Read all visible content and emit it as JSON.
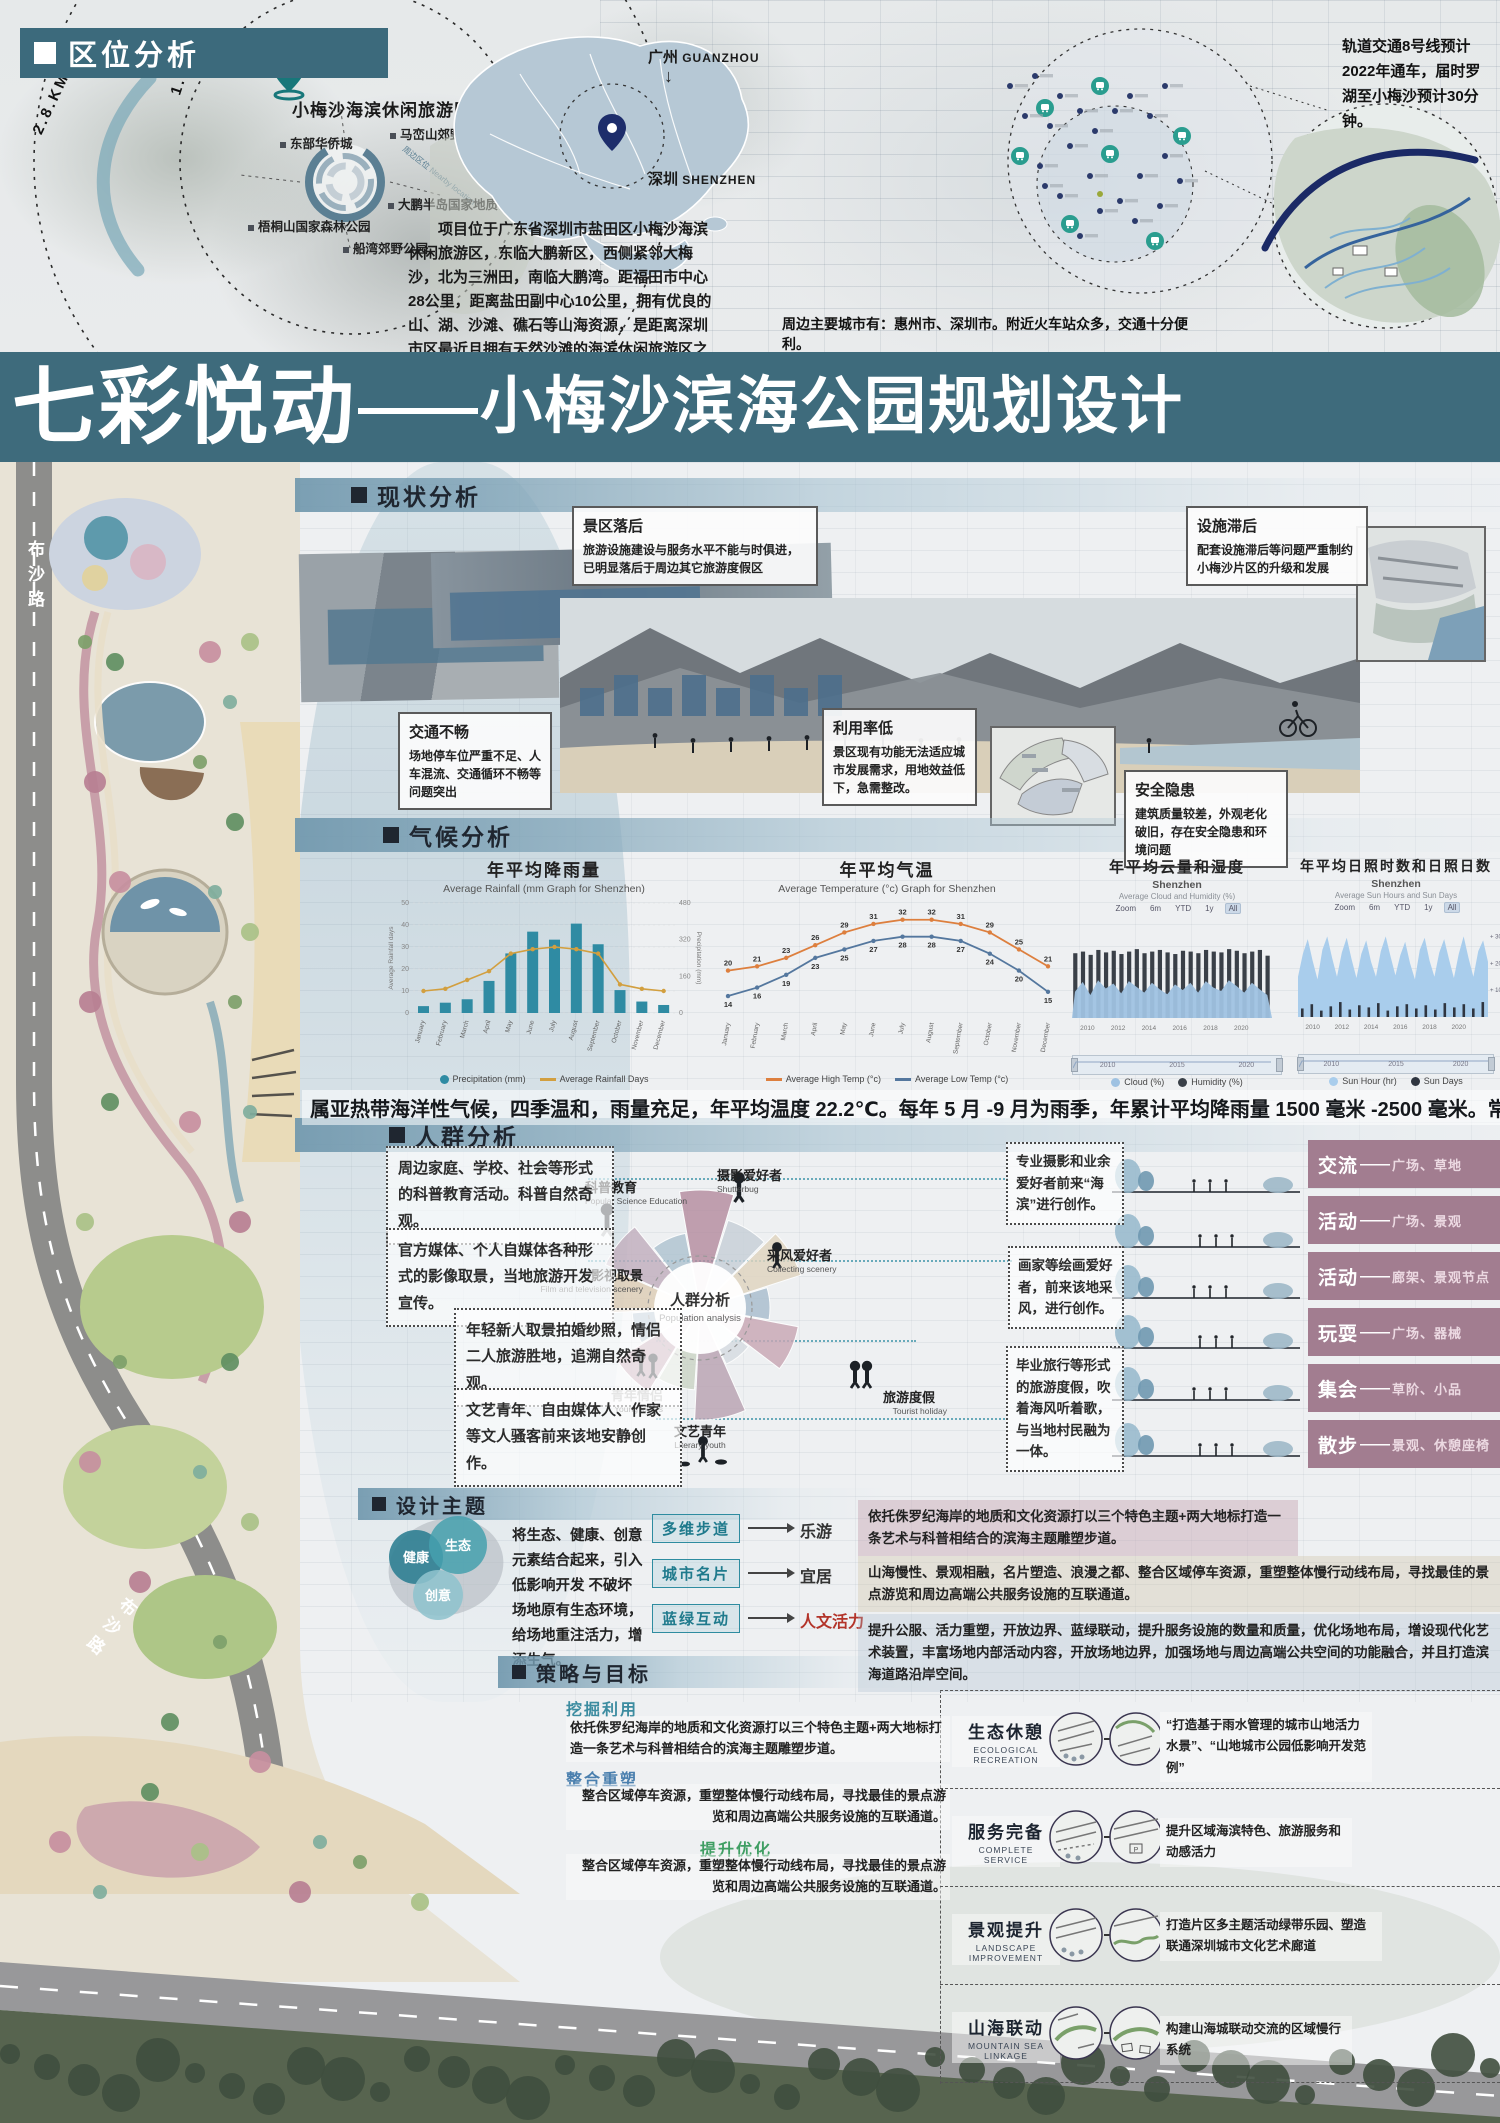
{
  "location_analysis": {
    "header": "区位分析",
    "radius_labels": [
      "2.8.KM",
      "1.0KM"
    ],
    "site_pin_label": "小梅沙海滨休闲旅游区",
    "nearby_ring_label": "周边区位 Nearby location",
    "poi_labels": [
      "东部华侨城",
      "马峦山郊野公园",
      "梧桐山国家森林公园",
      "船湾郊野公园",
      "大鹏半岛国家地质公园"
    ],
    "city_guangzhou": {
      "zh": "广州",
      "en": "GUANZHOU"
    },
    "city_shenzhen": {
      "zh": "深圳",
      "en": "SHENZHEN"
    },
    "arrow_down": "↓",
    "intro_paragraph": "项目位于广东省深圳市盐田区小梅沙海滨休闲旅游区，东临大鹏新区，西侧紧邻大梅沙，北为三洲田，南临大鹏湾。距福田市中心28公里，距离盐田副中心10公里，拥有优良的山、湖、沙滩、礁石等山海资源，是距离深圳市区最近且拥有天然沙滩的海滨休闲旅游区之一。",
    "transit_note": "轨道交通8号线预计2022年通车，届时罗湖至小梅沙预计30分钟。",
    "cities_note": "周边主要城市有：惠州市、深圳市。附近火车站众多，交通十分便利。"
  },
  "title_banner": {
    "lead": "七彩悦动",
    "dash": "——",
    "rest": "小梅沙滨海公园规划设计"
  },
  "masterplan": {
    "road_label": "布沙路"
  },
  "status_analysis": {
    "header": "现状分析",
    "callouts": [
      {
        "title": "景区落后",
        "body": "旅游设施建设与服务水平不能与时俱进，已明显落后于周边其它旅游度假区"
      },
      {
        "title": "设施滞后",
        "body": "配套设施滞后等问题严重制约小梅沙片区的升级和发展"
      },
      {
        "title": "交通不畅",
        "body": "场地停车位严重不足、人车混流、交通循环不畅等问题突出"
      },
      {
        "title": "利用率低",
        "body": "景区现有功能无法适应城市发展需求，用地效益低下，急需整改。"
      },
      {
        "title": "安全隐患",
        "body": "建筑质量较差，外观老化破旧，存在安全隐患和环境问题"
      }
    ]
  },
  "climate_analysis": {
    "header": "气候分析",
    "summary": "属亚热带海洋性气候，四季温和，雨量充足，年平均温度 22.2℃。每年 5 月 -9 月为雨季，年累计平均降雨量 1500 毫米 -2500 毫米。常年主导风向为东北偏北。"
  },
  "chart_data": [
    {
      "type": "bar",
      "title": "年平均降雨量",
      "subtitle": "Average Rainfall (mm Graph for Shenzhen)",
      "categories": [
        "January",
        "February",
        "March",
        "April",
        "May",
        "June",
        "July",
        "August",
        "September",
        "October",
        "November",
        "December"
      ],
      "series": [
        {
          "name": "Precipitation (mm)",
          "type": "bar",
          "color": "#2f8ba3",
          "values": [
            30,
            45,
            60,
            140,
            260,
            355,
            320,
            390,
            300,
            100,
            50,
            35
          ]
        },
        {
          "name": "Average Rainfall Days",
          "type": "line",
          "color": "#d29f3f",
          "values": [
            10,
            11,
            15,
            19,
            27,
            29,
            30,
            29,
            27,
            13,
            11,
            10
          ]
        }
      ],
      "y_left": {
        "label": "Average Rainfall days",
        "min": 0,
        "max": 50,
        "ticks": [
          0,
          10,
          20,
          30,
          40,
          50
        ]
      },
      "y_right": {
        "label": "Precipitation (mm)",
        "min": 0,
        "max": 480,
        "ticks": [
          0,
          160,
          320,
          480
        ]
      }
    },
    {
      "type": "line",
      "title": "年平均气温",
      "subtitle": "Average Temperature (°c) Graph for Shenzhen",
      "categories": [
        "January",
        "February",
        "March",
        "April",
        "May",
        "June",
        "July",
        "August",
        "September",
        "October",
        "November",
        "December"
      ],
      "series": [
        {
          "name": "Average High Temp (°c)",
          "type": "line",
          "color": "#dd7f3e",
          "values": [
            20,
            21,
            23,
            26,
            29,
            31,
            32,
            32,
            31,
            29,
            25,
            21
          ]
        },
        {
          "name": "Average Low Temp (°c)",
          "type": "line",
          "color": "#54779e",
          "values": [
            14,
            16,
            19,
            23,
            25,
            27,
            28,
            28,
            27,
            24,
            20,
            15
          ]
        }
      ],
      "ylim": [
        10,
        35
      ]
    },
    {
      "type": "heatmap",
      "title": "年平均云量和湿度",
      "subtitle": "Shenzhen",
      "note": "Average Cloud and Humidity (%)",
      "zoom_controls": [
        "Zoom",
        "6m",
        "YTD",
        "1y",
        "All"
      ],
      "active_control": "All",
      "x_ticks": [
        2010,
        2012,
        2014,
        2016,
        2018,
        2020
      ],
      "x_range": [
        2009,
        2022
      ],
      "scrubber_labels": [
        "2010",
        "2015",
        "2020"
      ],
      "series": [
        {
          "name": "Humidity (%)",
          "type": "bar",
          "color": "#3a4048",
          "values": [
            79,
            81,
            77,
            83,
            80,
            82,
            78,
            81,
            84,
            79,
            81,
            83,
            80,
            78,
            82,
            81,
            79,
            83,
            81,
            80,
            84,
            82,
            79,
            81,
            83,
            76
          ]
        },
        {
          "name": "Cloud (%)",
          "type": "area",
          "color": "#9fc2e2",
          "values": [
            32,
            44,
            28,
            46,
            36,
            42,
            30,
            45,
            38,
            31,
            43,
            35,
            29,
            41,
            34,
            43,
            31,
            45,
            37,
            33,
            46,
            39,
            31,
            43,
            35,
            28
          ]
        }
      ]
    },
    {
      "type": "area",
      "title": "年平均日照时数和日照日数",
      "subtitle": "Shenzhen",
      "note": "Average Sun Hours and Sun Days",
      "zoom_controls": [
        "Zoom",
        "6m",
        "YTD",
        "1y",
        "All"
      ],
      "active_control": "All",
      "x_ticks": [
        2010,
        2012,
        2014,
        2016,
        2018,
        2020
      ],
      "x_range": [
        2009,
        2022
      ],
      "y_right_ticks": [
        "+ 300hr",
        "+ 200hr",
        "+ 100hr"
      ],
      "scrubber_labels": [
        "2010",
        "2015",
        "2020"
      ],
      "series": [
        {
          "name": "Sun Hour (hr)",
          "type": "area",
          "color": "#a9cdec",
          "values": [
            150,
            235,
            290,
            210,
            140,
            250,
            300,
            220,
            150,
            240,
            295,
            215,
            145,
            235,
            285,
            205,
            150,
            245,
            300,
            225,
            155,
            230,
            280,
            200,
            140,
            250,
            295,
            210,
            150,
            240,
            290,
            215,
            145,
            235,
            300,
            220,
            150,
            245,
            285,
            205
          ]
        },
        {
          "name": "Sun Days",
          "type": "bar",
          "color": "#2f3540",
          "values": [
            8,
            12,
            6,
            10,
            14,
            7,
            11,
            9,
            13,
            6,
            10,
            12,
            8,
            11,
            7,
            13,
            9,
            12,
            8,
            14
          ]
        }
      ]
    }
  ],
  "population_analysis": {
    "header": "人群分析",
    "tag_separator": "——",
    "left_notes": [
      "周边家庭、学校、社会等形式的科普教育活动。科普自然奇观。",
      "官方媒体、个人自媒体各种形式的影像取景，当地旅游开发宣传。",
      "年轻新人取景拍婚纱照，情侣二人旅游胜地，追溯自然奇观。",
      "文艺青年、自由媒体人、作家等文人骚客前来该地安静创作。"
    ],
    "right_notes": [
      "专业摄影和业余爱好者前来“海滨”进行创作。",
      "画家等绘画爱好者，前来该地采风，进行创作。",
      "毕业旅行等形式的旅游度假，吹着海风听着歌，与当地村民融为一体。"
    ],
    "radial": {
      "center_zh": "人群分析",
      "center_en": "Population analysis",
      "groups": [
        {
          "zh": "科普教育",
          "en": "Popular Science Education"
        },
        {
          "zh": "摄影爱好者",
          "en": "Shutterbug"
        },
        {
          "zh": "影视取景",
          "en": "Film and television scenery"
        },
        {
          "zh": "采风爱好者",
          "en": "Collecting scenery"
        },
        {
          "zh": "青年情侣",
          "en": "Young lovers"
        },
        {
          "zh": "旅游度假",
          "en": "Tourist holiday"
        },
        {
          "zh": "文艺青年",
          "en": "Literary youth"
        }
      ]
    },
    "tags": [
      {
        "activity": "交流",
        "places": "广场、草地"
      },
      {
        "activity": "活动",
        "places": "广场、景观"
      },
      {
        "activity": "活动",
        "places": "廊架、景观节点"
      },
      {
        "activity": "玩耍",
        "places": "广场、器械"
      },
      {
        "activity": "集会",
        "places": "草阶、小品"
      },
      {
        "activity": "散步",
        "places": "景观、休憩座椅"
      }
    ]
  },
  "design_theme": {
    "header": "设计主题",
    "intro": "将生态、健康、创意元素结合起来，引入低影响开发 不破坏场地原有生态环境，给场地重注活力，增添生气。",
    "venn": [
      "健康",
      "生态",
      "创意"
    ],
    "flows": [
      {
        "from": "多维步道",
        "to": "乐游"
      },
      {
        "from": "城市名片",
        "to": "宜居"
      },
      {
        "from": "蓝绿互动",
        "to": "人文活力"
      }
    ],
    "right_paragraphs": [
      "依托侏罗纪海岸的地质和文化资源打以三个特色主题+两大地标打造一条艺术与科普相结合的滨海主题雕塑步道。",
      "山海慢性、景观相融，名片塑造、浪漫之都、整合区域停车资源，重塑整体慢行动线布局，寻找最佳的景点游览和周边高端公共服务设施的互联通道。",
      "提升公服、活力重塑，开放边界、蓝绿联动，提升服务设施的数量和质量，优化场地布局，增设现代化艺术装置，丰富场地内部活动内容，开放场地边界，加强场地与周边高端公共空间的功能融合，并且打造滨海道路沿岸空间。"
    ]
  },
  "strategy_goals": {
    "header": "策略与目标",
    "strategies": [
      {
        "title": "挖掘利用",
        "body": "依托侏罗纪海岸的地质和文化资源打以三个特色主题+两大地标打造一条艺术与科普相结合的滨海主题雕塑步道。"
      },
      {
        "title": "整合重塑",
        "body": "整合区域停车资源，重塑整体慢行动线布局，寻找最佳的景点游览和周边高端公共服务设施的互联通道。"
      },
      {
        "title": "提升优化",
        "body": "整合区域停车资源，重塑整体慢行动线布局，寻找最佳的景点游览和周边高端公共服务设施的互联通道。"
      }
    ],
    "goals": [
      {
        "title": "生态休憩",
        "en": "ECOLOGICAL RECREATION",
        "desc": "“打造基于雨水管理的城市山地活力水景”、“山地城市公园低影响开发范例”"
      },
      {
        "title": "服务完备",
        "en": "COMPLETE SERVICE",
        "desc": "提升区域海滨特色、旅游服务和动感活力"
      },
      {
        "title": "景观提升",
        "en": "LANDSCAPE IMPROVEMENT",
        "desc": "打造片区多主题活动绿带乐园、塑造联通深圳城市文化艺术廊道"
      },
      {
        "title": "山海联动",
        "en": "MOUNTAIN SEA LINKAGE",
        "desc": "构建山海城联动交流的区域慢行系统"
      }
    ]
  }
}
